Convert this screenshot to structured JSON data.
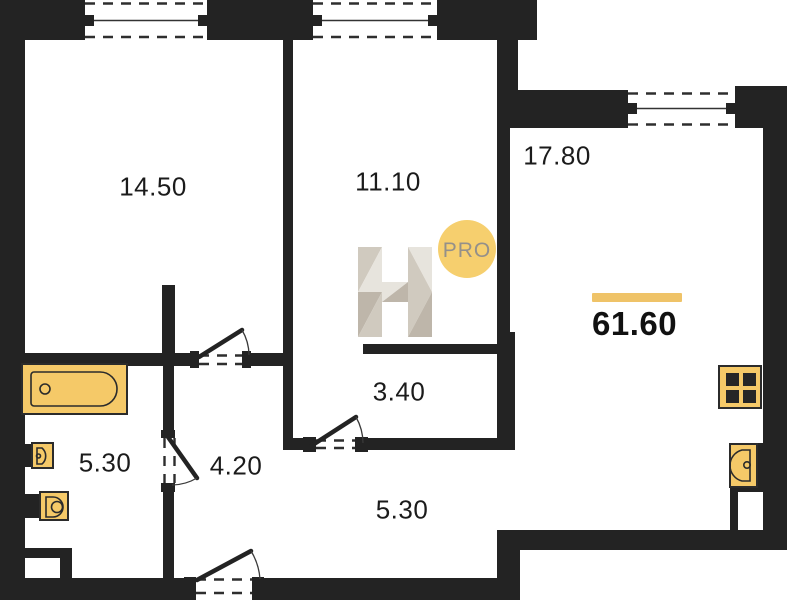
{
  "plan": {
    "type": "apartment-floor-plan",
    "rooms": [
      {
        "name": "bedroom",
        "area": "14.50"
      },
      {
        "name": "room",
        "area": "11.10"
      },
      {
        "name": "kitchen-living-room",
        "area": "17.80"
      },
      {
        "name": "inner-hall",
        "area": "3.40"
      },
      {
        "name": "bathroom",
        "area": "5.30"
      },
      {
        "name": "hall",
        "area": "4.20"
      },
      {
        "name": "corridor",
        "area": "5.30"
      }
    ],
    "total_area": "61.60",
    "watermark": {
      "letter": "H",
      "badge": "PRO"
    },
    "fixtures": [
      "bathtub-icon",
      "washbasin-icon",
      "toilet-icon",
      "stove-icon",
      "kitchen-sink-icon"
    ],
    "windows_count": 3,
    "doors_count": 4,
    "colors": {
      "wall": "#232323",
      "fixture_fill": "#F5C968",
      "fixture_outline": "#2b2b2b",
      "accent": "#EFC368",
      "badge_fill": "#F6CF6E",
      "badge_text": "#94908a",
      "watermark_light": "#E7E3DC",
      "watermark_mid": "#CFC8BD",
      "watermark_dark": "#BCB4A7",
      "label_text": "#1b1b1b"
    }
  }
}
